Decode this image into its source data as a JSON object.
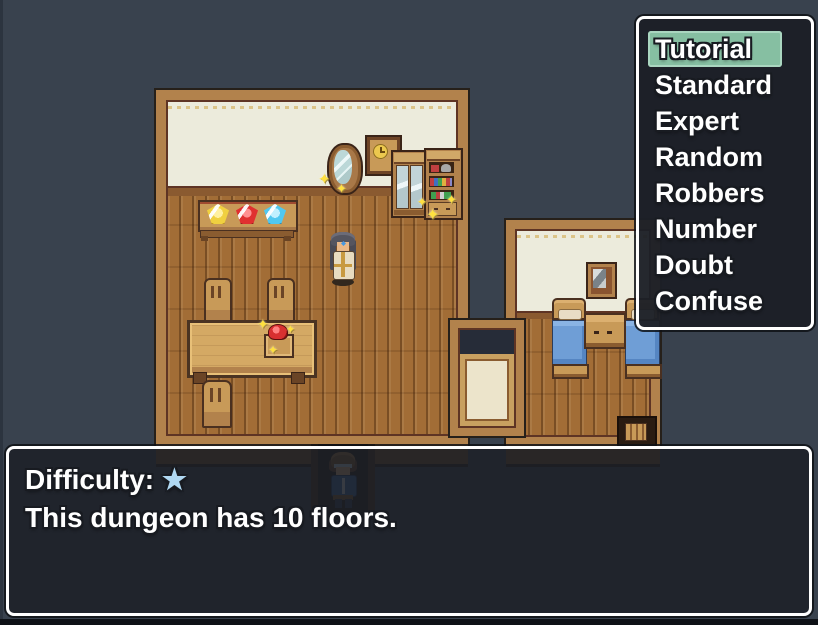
{
  "menu": {
    "items": [
      "Tutorial",
      "Standard",
      "Expert",
      "Random",
      "Robbers",
      "Number",
      "Doubt",
      "Confuse"
    ],
    "selected_index": 0
  },
  "message": {
    "difficulty_label": "Difficulty:",
    "difficulty_stars": "★",
    "body": "This dungeon has 10 floors."
  },
  "icons": {
    "sparkle": "✦"
  },
  "colors": {
    "background": "#39424e",
    "window_fill": "#1c1f27",
    "window_border": "#ffffff",
    "menu_highlight": "#86bfa2",
    "wall_cream": "#ecebdc",
    "wood_frame": "#b2824c",
    "wood_floor": "#a26d36",
    "text": "#ffffff",
    "difficulty_star": "#b0d8f2",
    "gem_yellow": "#f0d040",
    "gem_red": "#e03030",
    "gem_blue": "#50c8f0",
    "blanket_blue": "#6f9ed6"
  }
}
